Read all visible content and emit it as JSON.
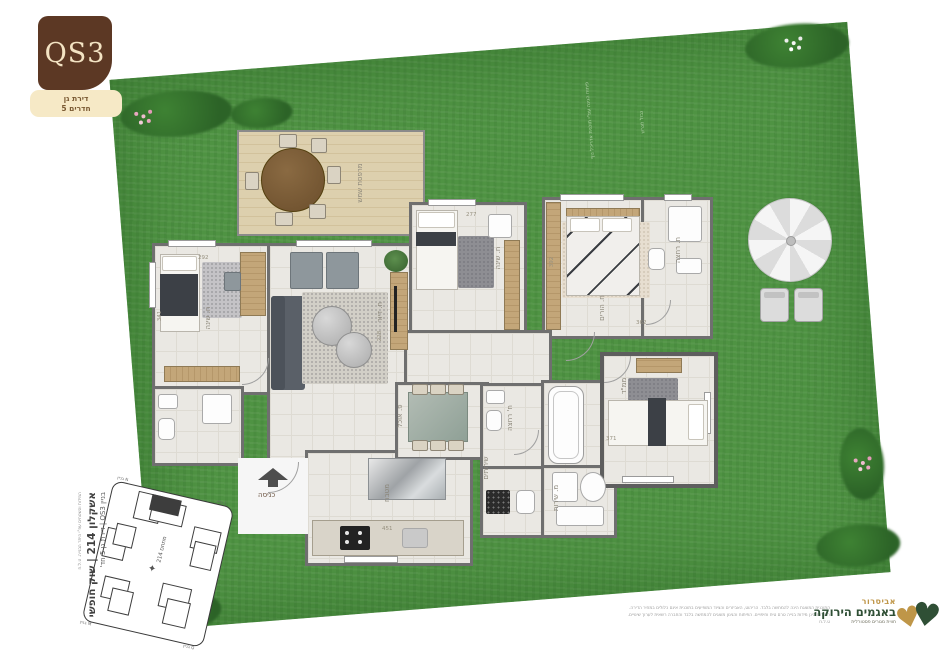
{
  "badge": {
    "code": "QS3",
    "line1": "דירת גן",
    "line2": "5 חדרים"
  },
  "plan": {
    "entrance": "כניסה",
    "labels": {
      "deck": "מרפסת שמש",
      "bedroom1": "ח. שינה",
      "living": "ח. דיור",
      "bedroom2": "ח. שינה",
      "master": "ח. הורים",
      "ensuite": "ח. רחצה",
      "mamad": "ממ\"ד",
      "dining": "פ. אוכל",
      "kitchen": "מטבח",
      "bath": "ח' רחצה",
      "wc": "שירותים",
      "service": "מ. שירות"
    },
    "dims": {
      "d292": "292",
      "d341": "341",
      "d277": "277",
      "d228": "228",
      "d392": "392",
      "d362": "362",
      "d371": "371",
      "d451": "451"
    },
    "garden": {
      "note1": "פיתוח הגינה עפ\"י תוכנית אדריכל נוף",
      "note2": "גבול מגרש"
    }
  },
  "siteplan": {
    "area": "מתחם 214",
    "corner1": "בניין N",
    "corner2": "בניין L",
    "corner3": "בניין M",
    "corner4": "בניין Q",
    "caption_small": "המידות והשטחים עפ\"י היתר הבנייה. ט.ל.ח",
    "caption_main": "אשקלון 214 | שוק חופשי",
    "caption_sub": "בניין QS3 | דירת גן 5 חד'"
  },
  "footer": {
    "disclaimer1": "התוכנית המוצגת הינה להמחשה בלבד. הריהוט, האביזרים והציוד המופיעים בתוכנית אינם כלולים במחיר הדירה.",
    "disclaimer2": "המידות הינן מידות בנייה טרם טיח וחיפויים. הפיתוח והגינון מוצגים להמחשה בלבד והחברה רשאית לערוך שינויים.",
    "disclaimer3": "ט.ל.ח",
    "brand_top": "אביסרור",
    "brand_main": "באגמים הירוקה",
    "brand_tagline": "חווית מגורים פסטורלית"
  },
  "colors": {
    "badge_brown": "#5c3824",
    "label_cream": "#f6e9c6",
    "grass": "#4f9343",
    "wall": "#6f6f6f",
    "floor": "#eae8e3",
    "deck_wood": "#dbcdab",
    "brand_gold": "#bf9648",
    "brand_green": "#2f4f35"
  }
}
